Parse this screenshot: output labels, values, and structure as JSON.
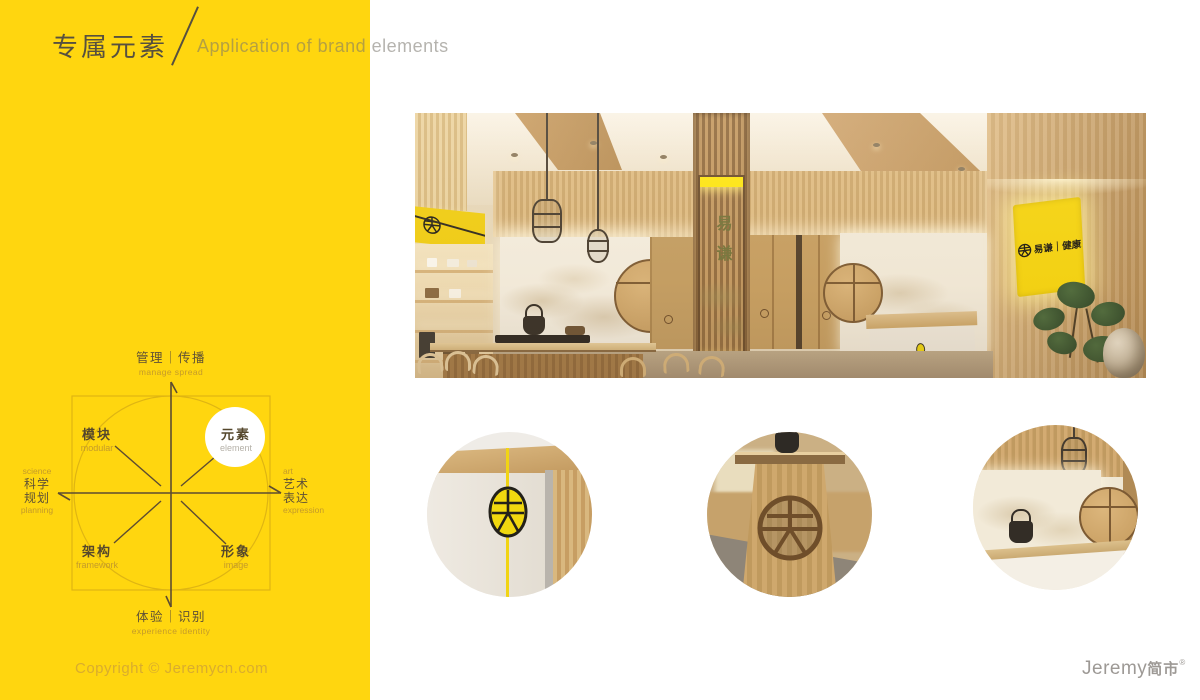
{
  "header": {
    "title_zh": "专属元素",
    "title_en": "Application of brand elements"
  },
  "diagram": {
    "top": {
      "zh": "管理｜传播",
      "en": "manage spread"
    },
    "bottom": {
      "zh": "体验｜识别",
      "en": "experience identity"
    },
    "left": {
      "en_top": "science",
      "zh1": "科学",
      "zh2": "规划",
      "en_bottom": "planning"
    },
    "right": {
      "en_top": "art",
      "zh1": "艺术",
      "zh2": "表达",
      "en_bottom": "expression"
    },
    "quadrants": [
      {
        "zh": "模块",
        "en": "modular",
        "highlighted": false
      },
      {
        "zh": "元素",
        "en": "element",
        "highlighted": true
      },
      {
        "zh": "架构",
        "en": "framework",
        "highlighted": false
      },
      {
        "zh": "形象",
        "en": "image",
        "highlighted": false
      }
    ]
  },
  "interior": {
    "column_banner_text": "易谦",
    "wall_sign_text": "易谦｜健康"
  },
  "footer": {
    "copyright": "Copyright © Jeremycn.com",
    "logo_en": "Jeremy",
    "logo_zh": "简市",
    "registered": "®"
  },
  "colors": {
    "accent_yellow": "#FFD60F",
    "sign_yellow": "#F7D60E",
    "dark_text": "#57503F",
    "tan_label": "#C49A2A"
  }
}
